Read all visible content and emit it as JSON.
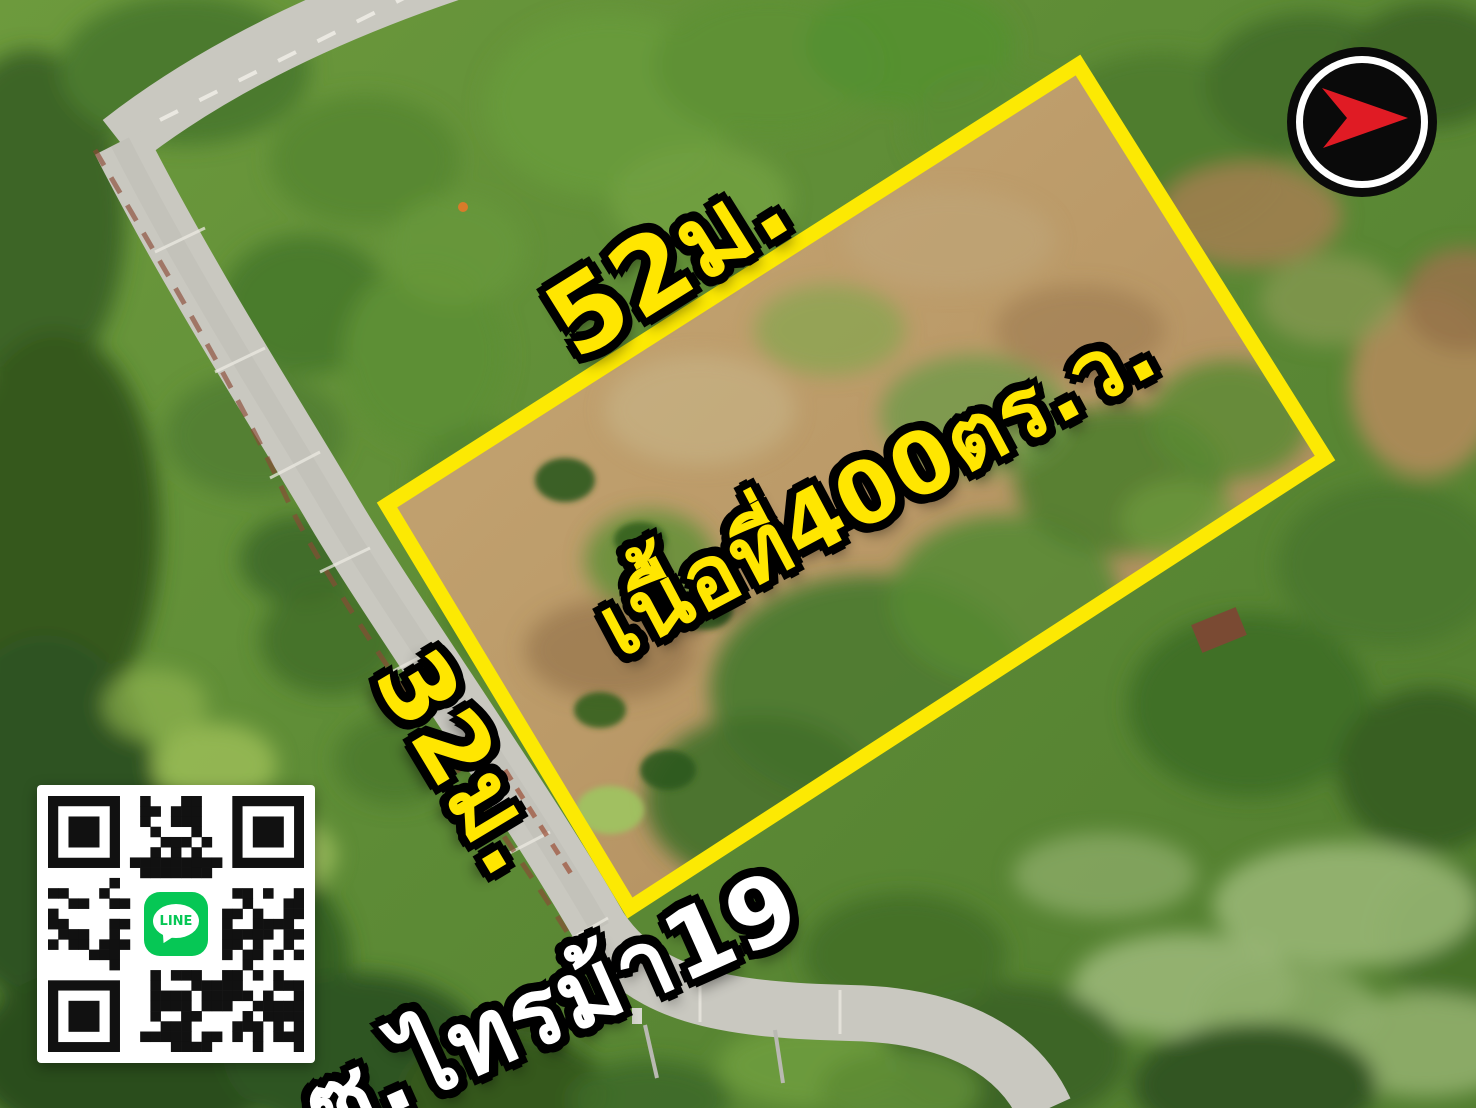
{
  "annotations": {
    "top_dimension": "52ม.",
    "side_dimension": "32ม.",
    "area_label": "เนื้อที่400ตร.ว.",
    "road_label": "ซ.ไทรม้า19"
  },
  "qr_badge": {
    "label": "LINE"
  },
  "colors": {
    "boundary_yellow": "#fce903",
    "dimension_text": "#ffe600",
    "road_text": "#ffffff",
    "line_green": "#06c755",
    "logo_arrow_red": "#e01b24",
    "logo_circle_black": "#0a0a0a"
  }
}
